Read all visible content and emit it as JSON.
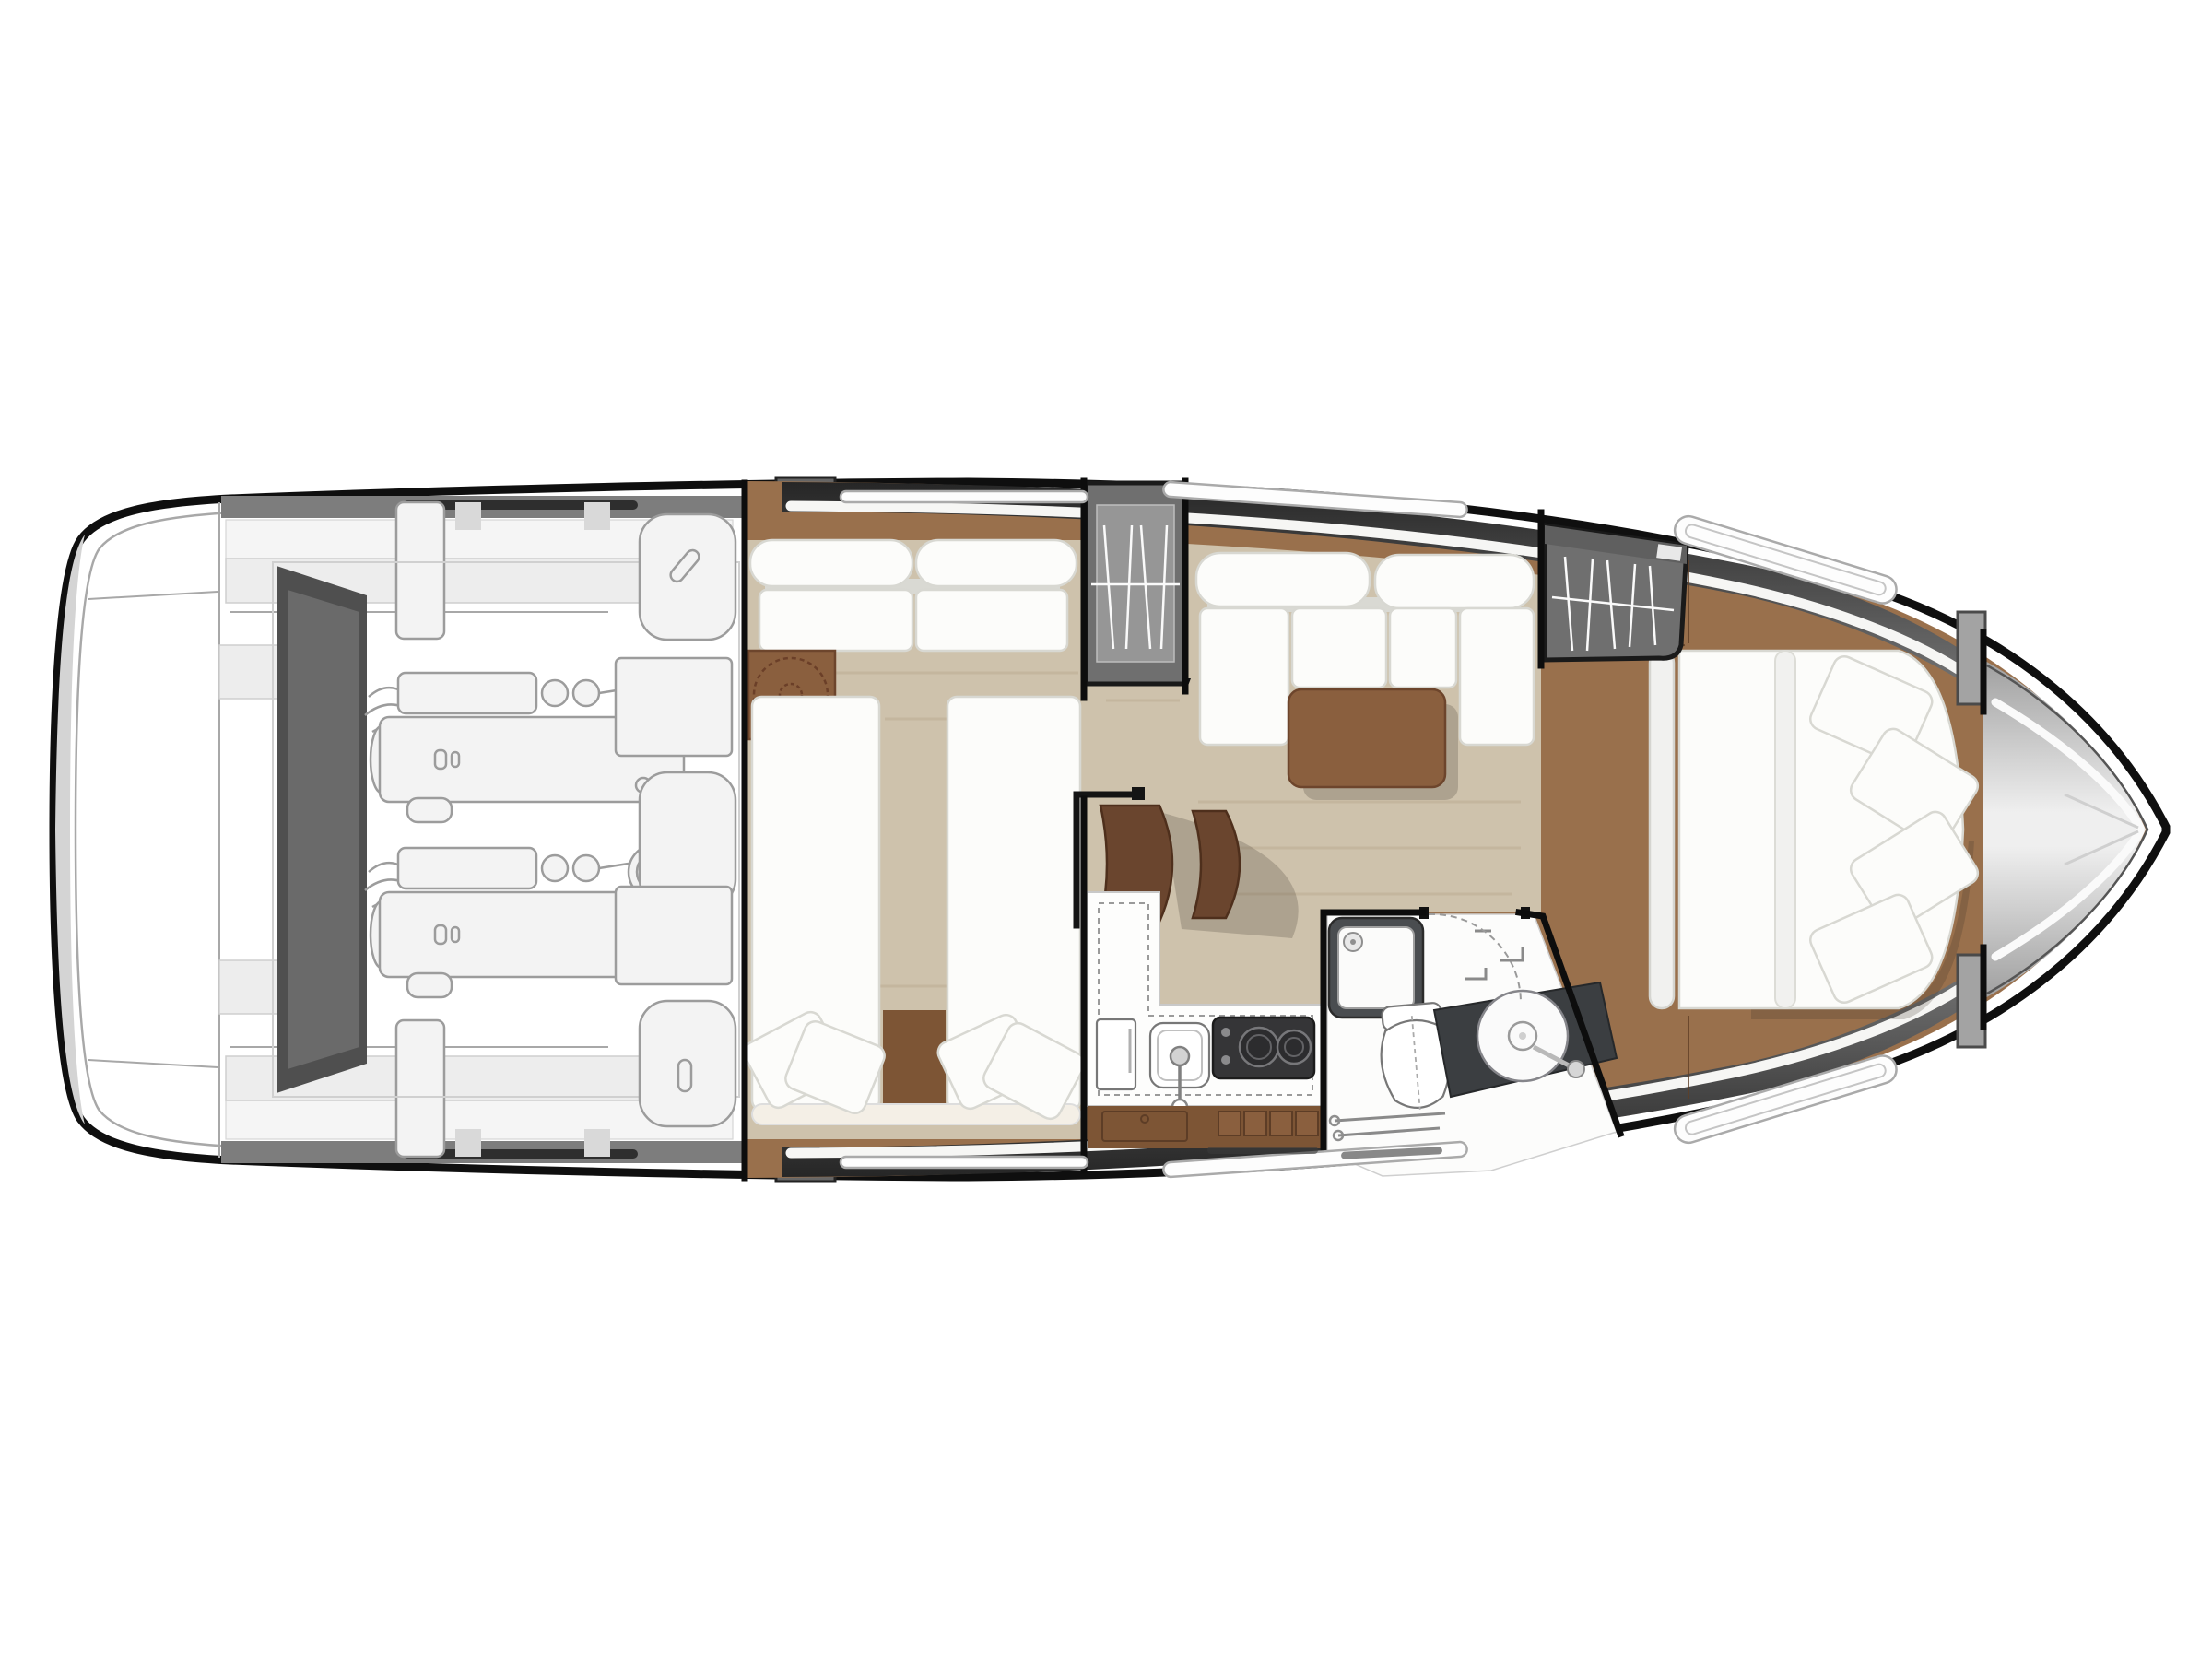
{
  "page": {
    "kind": "boat-floor-plan",
    "description": "Top-down interior layout plan of a motor yacht, bow pointing right, no text labels rendered",
    "background": "#ffffff"
  },
  "colors": {
    "hull": "#ffffff",
    "outline": "#0f0f0f",
    "innerline": "#a8a8a8",
    "band-dark": "#262626",
    "band-mid": "#767676",
    "roof-gray": "#7d7d7d",
    "deck-light": "#ededed",
    "deck-lighter": "#f5f5f5",
    "art-fill": "#f3f3f3",
    "art-stroke": "#9c9c9c",
    "wedge": "#4f4f4f",
    "teak": "#99704c",
    "teak-dark": "#7d5535",
    "teak-edge": "#5f3f26",
    "tan": "#cec2ac",
    "tan-streak": "#b7a88f",
    "white-soft": "#fcfcfa",
    "cushion-stroke": "#d8d8d2",
    "cushion-shadow": "#d9d9d3",
    "table": "#8a5f3e",
    "step": "#6a452e",
    "step-edge": "#4e2f1c",
    "wardrobe": "#6f6f6f",
    "wardrobe-inner": "#969696",
    "counter-dark": "#3b3e41",
    "stove": "#353537",
    "wall": "#0d0d0d",
    "cream": "#f4efe6",
    "shadow": "rgba(60,50,40,0.22)",
    "bow-shade": "#9f9f9f",
    "bow-light": "#efefef"
  },
  "rooms": [
    {
      "id": "swim-platform",
      "label": "Swim platform and transom"
    },
    {
      "id": "cockpit",
      "label": "Aft cockpit with bench seating and roof supports"
    },
    {
      "id": "engine-room",
      "label": "Engine room with twin inboard engines"
    },
    {
      "id": "tank-compartment",
      "label": "Tank and systems compartment"
    },
    {
      "id": "guest-cabin",
      "label": "Mid guest cabin with sofa, table and twin beds"
    },
    {
      "id": "companionway",
      "label": "Companionway steps with black handrail"
    },
    {
      "id": "salon",
      "label": "Salon with C-shaped settee and wood table"
    },
    {
      "id": "galley",
      "label": "Galley with fridge, sink, two-burner stove and drawers"
    },
    {
      "id": "head",
      "label": "Head with shower, toilet and vanity washbasin"
    },
    {
      "id": "master-cabin",
      "label": "Forward master cabin with island double bed and wardrobe"
    },
    {
      "id": "foredeck",
      "label": "Foredeck and bow"
    }
  ],
  "inventory": {
    "engines": 2,
    "fuel_water_tanks": 3,
    "twin_beds": 2,
    "double_beds": 1,
    "wardrobes_with_hangers": 2,
    "stove_burners": 2,
    "sinks": 2,
    "toilets": 1,
    "showers": 1,
    "guest_pillows": 4,
    "master_pillows": 4,
    "salon_settee_cushions": 4,
    "guest_sofa_cushions": 2,
    "companionway_steps": 2,
    "side_window_slits_per_side": 3
  }
}
